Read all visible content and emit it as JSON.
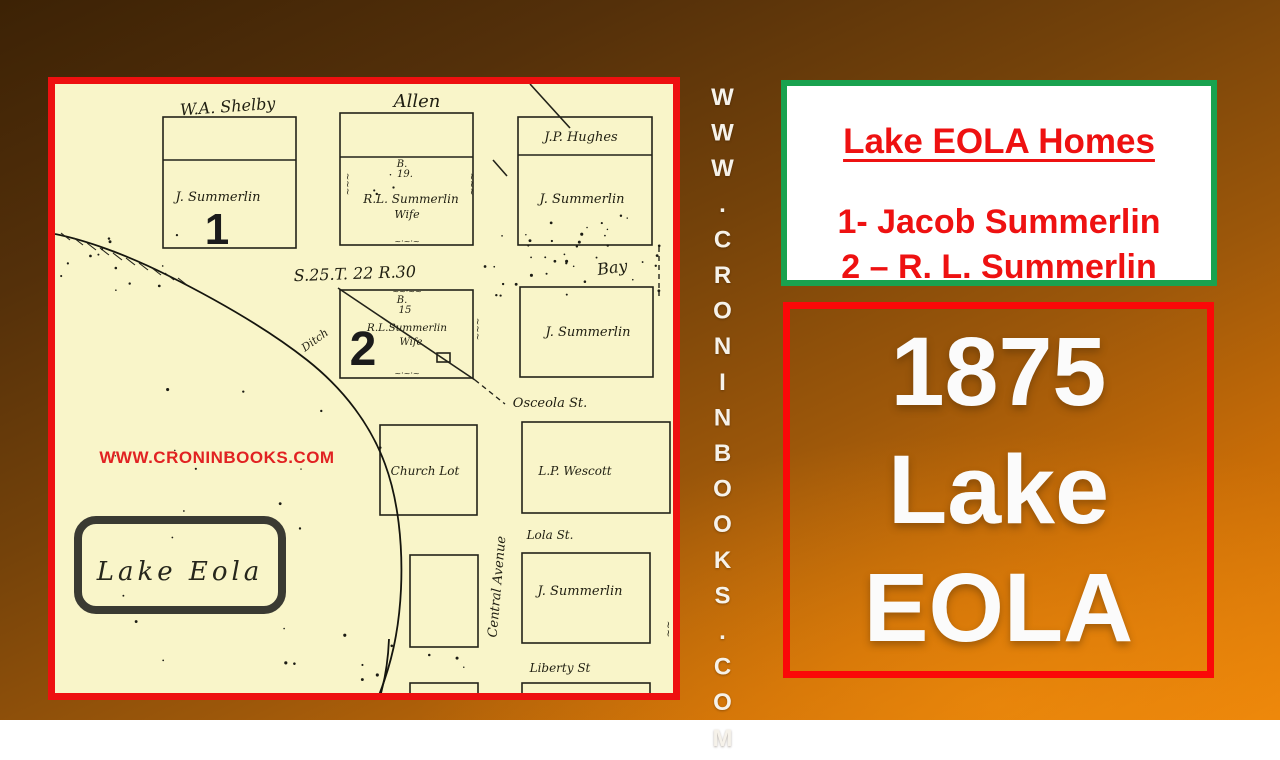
{
  "slide": {
    "background_top": "#3c2205",
    "background_bottom": "#ea840a"
  },
  "map_panel": {
    "border_color": "#ee1010",
    "paper_color": "#f9f5c9",
    "labels": [
      {
        "t": "W.A. Shelby",
        "x": 173,
        "y": 28,
        "s": 16,
        "r": -4
      },
      {
        "t": "Allen",
        "x": 362,
        "y": 23,
        "s": 18
      },
      {
        "t": "J.P. Hughes",
        "x": 526,
        "y": 57,
        "s": 13
      },
      {
        "t": "J. Summerlin",
        "x": 163,
        "y": 117,
        "s": 13
      },
      {
        "t": "1",
        "x": 162,
        "y": 160,
        "s": 44,
        "c": "num"
      },
      {
        "t": "B.",
        "x": 347,
        "y": 83,
        "s": 10
      },
      {
        "t": "19.",
        "x": 350,
        "y": 93,
        "s": 10
      },
      {
        "t": "R.L. Summerlin",
        "x": 356,
        "y": 119,
        "s": 12
      },
      {
        "t": "Wife",
        "x": 352,
        "y": 134,
        "s": 11
      },
      {
        "t": "J. Summerlin",
        "x": 527,
        "y": 119,
        "s": 13
      },
      {
        "t": "S.25.T. 22 R.30",
        "x": 300,
        "y": 195,
        "s": 16,
        "r": -2
      },
      {
        "t": "Bay",
        "x": 558,
        "y": 189,
        "s": 16,
        "r": -8
      },
      {
        "t": "2",
        "x": 308,
        "y": 281,
        "s": 48,
        "c": "num"
      },
      {
        "t": "B.",
        "x": 347,
        "y": 219,
        "s": 10
      },
      {
        "t": "15",
        "x": 350,
        "y": 229,
        "s": 10
      },
      {
        "t": "R.L.Summerlin",
        "x": 352,
        "y": 247,
        "s": 10.5
      },
      {
        "t": "Wife",
        "x": 356,
        "y": 261,
        "s": 10
      },
      {
        "t": "Ditch",
        "x": 262,
        "y": 259,
        "s": 11,
        "r": -36
      },
      {
        "t": "J. Summerlin",
        "x": 533,
        "y": 252,
        "s": 13
      },
      {
        "t": "Osceola St.",
        "x": 495,
        "y": 323,
        "s": 13
      },
      {
        "t": "Church Lot",
        "x": 370,
        "y": 391,
        "s": 12
      },
      {
        "t": "L.P. Wescott",
        "x": 520,
        "y": 391,
        "s": 12
      },
      {
        "t": "Lola St.",
        "x": 495,
        "y": 455,
        "s": 12
      },
      {
        "t": "Central Avenue",
        "x": 446,
        "y": 503,
        "s": 13,
        "r": -85
      },
      {
        "t": "J. Summerlin",
        "x": 525,
        "y": 511,
        "s": 13
      },
      {
        "t": "Liberty St",
        "x": 505,
        "y": 588,
        "s": 12
      },
      {
        "t": "~~~",
        "x": 290,
        "y": 100,
        "s": 9,
        "r": 90
      },
      {
        "t": "~~~",
        "x": 414,
        "y": 100,
        "s": 9,
        "r": 90
      },
      {
        "t": "~~~",
        "x": 420,
        "y": 245,
        "s": 9,
        "r": 90
      },
      {
        "t": "~~",
        "x": 610,
        "y": 545,
        "s": 10,
        "r": 90
      },
      {
        "t": "~·~·~",
        "x": 352,
        "y": 160,
        "s": 8
      },
      {
        "t": "~~·~~",
        "x": 352,
        "y": 210,
        "s": 8
      },
      {
        "t": "~·~·~",
        "x": 352,
        "y": 292,
        "s": 8
      },
      {
        "t": "Lake Eola",
        "x": 125,
        "y": 496,
        "s": 26,
        "c": "lakeName"
      },
      {
        "t": "WWW.CRONINBOOKS.COM",
        "x": 162,
        "y": 379,
        "s": 17,
        "c": "wm"
      }
    ],
    "geometry": {
      "rects": [
        [
          108,
          33,
          133,
          131
        ],
        [
          285,
          29,
          133,
          132
        ],
        [
          463,
          33,
          134,
          128
        ],
        [
          285,
          206,
          133,
          88
        ],
        [
          465,
          203,
          133,
          90
        ],
        [
          325,
          341,
          97,
          90
        ],
        [
          467,
          338,
          148,
          91
        ],
        [
          355,
          471,
          68,
          92
        ],
        [
          467,
          469,
          128,
          90
        ],
        [
          355,
          599,
          68,
          12
        ],
        [
          467,
          599,
          128,
          12
        ],
        [
          382,
          269,
          13,
          9
        ]
      ],
      "lines": [
        [
          108,
          76,
          241,
          76
        ],
        [
          285,
          73,
          418,
          73
        ],
        [
          463,
          71,
          597,
          71
        ],
        [
          475,
          0,
          515,
          44
        ],
        [
          438,
          76,
          452,
          92
        ],
        [
          283,
          204,
          420,
          296
        ]
      ],
      "dashed": [
        [
          420,
          296,
          450,
          320
        ],
        [
          604,
          163,
          604,
          212
        ]
      ],
      "shore": [
        "M0,150 C30,156 70,170 112,191 C160,215 210,243 252,276 C290,306 316,342 330,380 C343,415 348,460 346,505 C344,548 336,582 322,616",
        "M334,555 C333,580 329,600 324,616"
      ],
      "lake_box": [
        23,
        436,
        204,
        90
      ],
      "dot_regions": [
        [
          430,
          150,
          175,
          62,
          30
        ],
        [
          5,
          150,
          125,
          60,
          14
        ],
        [
          20,
          250,
          310,
          330,
          20
        ],
        [
          468,
          126,
          130,
          38,
          10
        ],
        [
          235,
          560,
          190,
          42,
          8
        ],
        [
          300,
          90,
          40,
          30,
          4
        ]
      ]
    }
  },
  "vertical_url": {
    "text": "WWW.CRONINBOOKS.COM"
  },
  "legend_box": {
    "border_color": "#19a24f",
    "text_color": "#ee1111",
    "title": "Lake EOLA Homes",
    "items": [
      "1- Jacob Summerlin",
      "2 – R. L. Summerlin"
    ]
  },
  "title_box": {
    "border_color": "#fb0808",
    "text_color": "#fbfbfb",
    "lines": [
      "1875",
      "Lake",
      "EOLA"
    ]
  }
}
